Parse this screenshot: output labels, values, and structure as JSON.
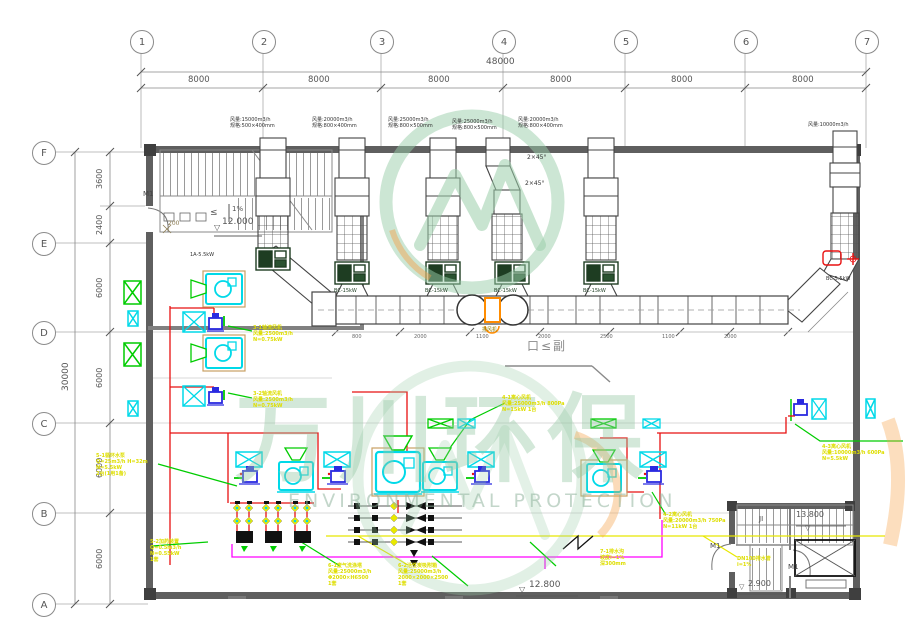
{
  "watermark": {
    "cn": "万川环保",
    "en": "ENVIRONMENTAL PROTECTION"
  },
  "grid": {
    "cols": [
      "1",
      "2",
      "3",
      "4",
      "5",
      "6",
      "7"
    ],
    "rows": [
      "F",
      "E",
      "D",
      "C",
      "B",
      "A"
    ],
    "col_total": "48000",
    "col_bay": "8000",
    "row_total": "30000",
    "row_segs": [
      "3600",
      "2400",
      "6000",
      "6000",
      "6000",
      "6000"
    ]
  },
  "levels": {
    "tl": "12.000",
    "bm": "12.800",
    "br_up": "13.800",
    "br_dn": "2.900"
  },
  "notes": {
    "slope": "1%",
    "sill": "200",
    "leq": "≤",
    "door": "M1",
    "stair": "JI",
    "elbow": "2×45°",
    "section": "口≤副",
    "drain": "排风机",
    "tri": "▽"
  },
  "stacks": {
    "s1": [
      "风量:15000m3/h",
      "规格:500×400mm"
    ],
    "s2": [
      "风量:20000m3/h",
      "规格:800×400mm"
    ],
    "s3": [
      "风量:25000m3/h",
      "规格:800×500mm"
    ],
    "s4": [
      "风量:25000m3/h",
      "规格:800×500mm"
    ],
    "s5": [
      "风量:20000m3/h",
      "规格:800×400mm"
    ],
    "s6": "风量:10000m3/h"
  },
  "fans": [
    "1A-5.5kW",
    "BC-15kW",
    "BC-15kW",
    "BC-15kW",
    "BC-15kW",
    "BC-5.5kW"
  ],
  "duct_dims": [
    "800",
    "2000",
    "1100",
    "2000",
    "2500",
    "1100",
    "2000"
  ],
  "annotations": {
    "a1": [
      "3-1轴流风机",
      "风量:2500m3/h",
      "N=0.75kW"
    ],
    "a2": [
      "3-2轴流风机",
      "风量:2500m3/h",
      "N=0.75kW"
    ],
    "l1": [
      "5-1循环水泵",
      "Q=25m3/h H=32m",
      "N=5.5kW",
      "2台(1用1备)"
    ],
    "l2": [
      "5-2加药装置",
      "Q=0.5m3/h",
      "N=0.55kW",
      "1套"
    ],
    "m1": [
      "6-1废气洗涤塔",
      "风量:25000m3/h",
      "Φ2000×H6500",
      "1套"
    ],
    "m2": [
      "6-2活性炭吸附箱",
      "风量:25000m3/h",
      "2000×2000×2500",
      "1套"
    ],
    "c1": [
      "4-1离心风机",
      "风量:25000m3/h 800Pa",
      "N=15kW 1台"
    ],
    "r1": [
      "4-2离心风机",
      "风量:20000m3/h 750Pa",
      "N=11kW 1台"
    ],
    "b1": [
      "7-1排水沟",
      "坡度i=1%",
      "深300mm"
    ],
    "r2": [
      "4-3离心风机",
      "风量:10000m3/h 600Pa",
      "N=5.5kW"
    ],
    "y2": [
      "DN100排水管",
      "i=1%"
    ]
  },
  "colors": {
    "wall": "#5f5f5f",
    "cyan": "#00d9e8",
    "green": "#00cc00",
    "yellow": "#e8e800",
    "red": "#e81010",
    "magenta": "#ff00ff",
    "orange": "#ff8c00",
    "tan": "#c9a063",
    "watermark_green": "#96c8a5"
  }
}
